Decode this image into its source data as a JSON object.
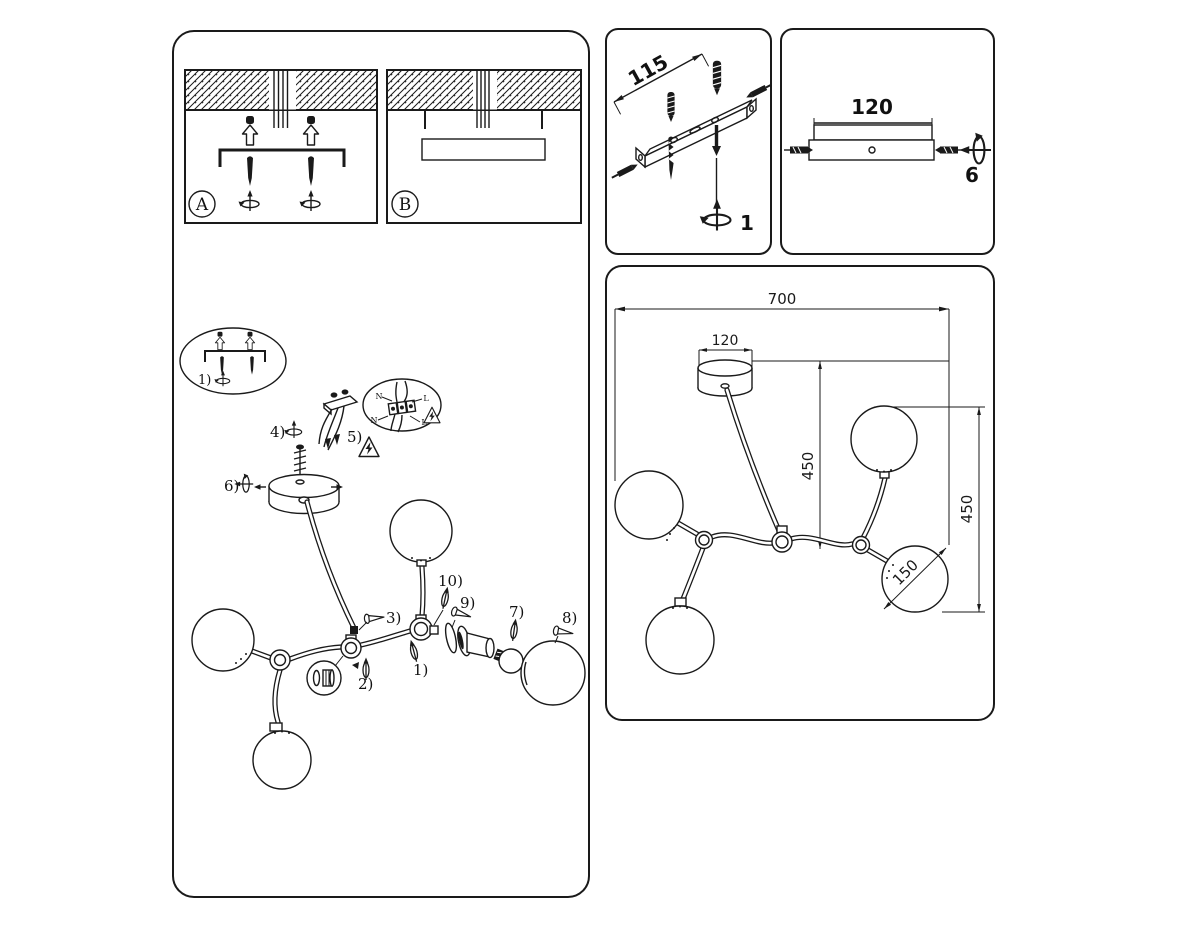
{
  "instructions_card": {
    "panel_a": {
      "label": "A"
    },
    "panel_b": {
      "label": "B"
    },
    "steps": {
      "s1": "1)",
      "s2": "2)",
      "s3": "3)",
      "s4": "4)",
      "s5": "5)",
      "s6": "6)",
      "s7": "7)",
      "s8": "8)",
      "s9": "9)",
      "s10": "10)"
    },
    "wiring_detail": {
      "neutral_top": "N",
      "live_top": "L",
      "neutral_bottom": "N",
      "live_bottom": "L"
    }
  },
  "bracket_card": {
    "hole_spacing_mm": "115",
    "step": "1"
  },
  "canopy_card": {
    "width_mm": "120",
    "step": "6"
  },
  "dimensions_card": {
    "overall_width_mm": "700",
    "canopy_width_mm": "120",
    "center_drop_mm": "450",
    "side_drop_mm": "450",
    "globe_diameter_mm": "150"
  },
  "colors": {
    "line": "#1a1a1a",
    "background": "#ffffff"
  }
}
